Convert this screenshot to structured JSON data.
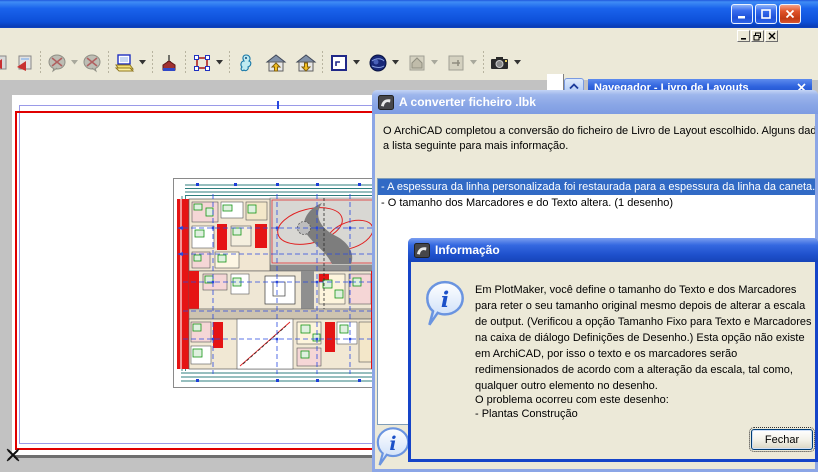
{
  "window": {
    "title": ""
  },
  "navigator": {
    "title": "Navegador - Livro de Layouts"
  },
  "toolbar": {
    "icons": [
      "add-to-publisher-partial",
      "add-to-publisher",
      "markup-disabled",
      "markup-dropdown-disabled",
      "markup-2-disabled",
      "layout-settings",
      "layout-settings-dropdown",
      "plumb-reference",
      "marquee",
      "marquee-dropdown",
      "navigator-preview",
      "go-up-story",
      "go-down-story",
      "layout",
      "layout-dropdown",
      "view-globe",
      "view-globe-dropdown",
      "model-disabled",
      "model-dropdown-disabled",
      "section-disabled",
      "section-dropdown-disabled",
      "camera",
      "camera-dropdown"
    ]
  },
  "converter_dialog": {
    "title": "A converter ficheiro .lbk",
    "message_line1": "O ArchiCAD completou a conversão do ficheiro de Livro de Layout escolhido. Alguns dados nã",
    "message_line2": "a lista seguinte para mais informação.",
    "list_items": [
      {
        "text": "- A espessura da linha personalizada foi restaurada para a espessura da linha da caneta. (4",
        "selected": true
      },
      {
        "text": "- O tamanho dos Marcadores e do Texto altera. (1 desenho)",
        "selected": false
      }
    ]
  },
  "info_dialog": {
    "title": "Informação",
    "paragraph": "Em PlotMaker, você define o tamanho do Texto e dos Marcadores para reter o seu tamanho original mesmo depois de alterar a escala de output. (Verificou a opção Tamanho Fixo para Texto e Marcadores na caixa de diálogo Definições de Desenho.) Esta opção não existe em ArchiCAD, por isso o texto e os marcadores serão redimensionados de acordo com a alteração da escala, tal como, qualquer outro elemento no desenho.",
    "problem_heading": "O problema ocorreu com este desenho:",
    "problem_item": "- Plantas Construção",
    "close_button": "Fechar"
  },
  "colors": {
    "titlebar_blue": "#0d4fd8",
    "inactive_title_blue": "#8aa6e6",
    "active_title_blue": "#1e50cc",
    "dialog_bg": "#ece9d8",
    "selection_blue": "#316ac5",
    "canvas_gray": "#c2c2c2",
    "page_border_red": "#e00000",
    "list_border": "#7f9db9"
  }
}
